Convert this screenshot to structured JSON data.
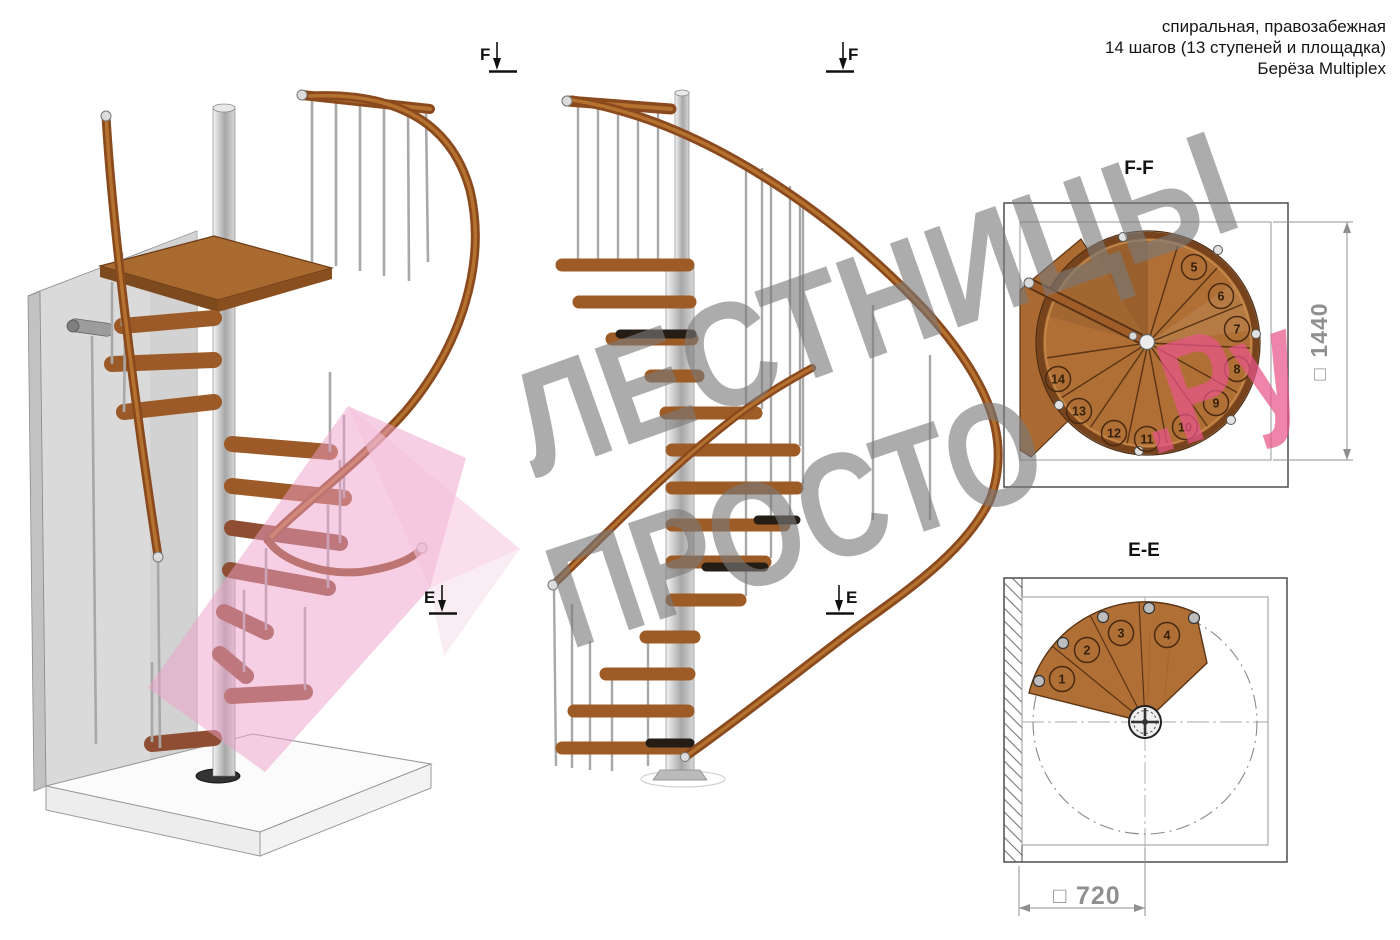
{
  "header": {
    "line1": "спиральная, правозабежная",
    "line2": "14 шагов (13 ступеней и площадка)",
    "line3": "Берёза Multiplex"
  },
  "watermark": {
    "line1": "ЛЕСТНИЦЫ",
    "line2": "ПРОСТО",
    "line2_suffix": ".Ру"
  },
  "section_markers": {
    "f": "F",
    "e": "E"
  },
  "views": {
    "ff_plan": {
      "title": "F-F",
      "dimension_symbol": "□",
      "dimension": "1440",
      "step_numbers": [
        "5",
        "6",
        "7",
        "8",
        "9",
        "10",
        "11",
        "12",
        "13",
        "14"
      ]
    },
    "ee_plan": {
      "title": "E-E",
      "dimension_symbol": "□",
      "dimension": "720",
      "step_numbers": [
        "1",
        "2",
        "3",
        "4"
      ]
    }
  },
  "colors": {
    "wood": "#b06f35",
    "wood_dark": "#5a3415",
    "metal": "#c9c9c9",
    "pink_plane": "#ef9fca",
    "watermark_gray": "#7a7a7a",
    "watermark_pink": "#e8558a",
    "dimension_gray": "#8f8f8f"
  }
}
